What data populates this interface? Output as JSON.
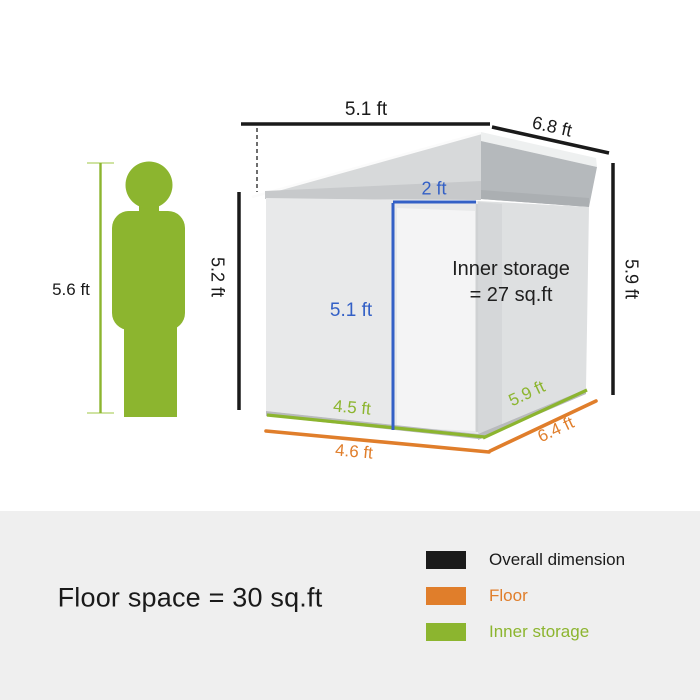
{
  "colors": {
    "green": "#8CB52F",
    "light_green": "#CFE3A2",
    "orange": "#E07E2B",
    "blue": "#3360C6",
    "black": "#1A1A1A",
    "panel_gray": "#EFEFEF"
  },
  "figure": {
    "height_label": "5.6 ft"
  },
  "shed": {
    "overall": {
      "width": "5.1 ft",
      "depth": "6.8 ft",
      "left_height": "5.2 ft",
      "right_height": "5.9 ft"
    },
    "door": {
      "width": "2 ft",
      "height": "5.1 ft"
    },
    "inner": {
      "width": "4.5 ft",
      "depth": "5.9 ft",
      "note_line1": "Inner storage",
      "note_line2": "= 27 sq.ft"
    },
    "floor": {
      "width": "4.6 ft",
      "depth": "6.4 ft"
    }
  },
  "footer": {
    "floor_space": "Floor space = 30 sq.ft",
    "legend": {
      "overall": {
        "label": "Overall dimension",
        "color": "#1A1A1A"
      },
      "floor": {
        "label": "Floor",
        "color": "#E07E2B"
      },
      "inner": {
        "label": "Inner storage",
        "color": "#8CB52F"
      }
    }
  }
}
